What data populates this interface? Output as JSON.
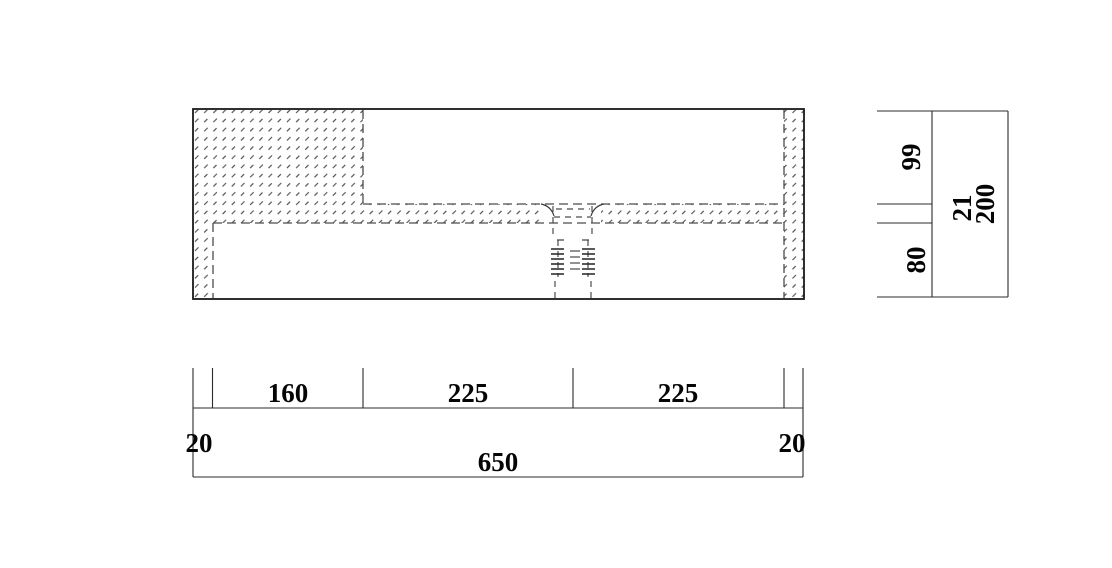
{
  "page": {
    "background": "#ffffff"
  },
  "colors": {
    "outline": "#1a1a1a",
    "hidden_line": "#4c4c4c",
    "hatch": "#3f3f3f",
    "dimension_line": "#2b2b2b",
    "text": "#050505"
  },
  "dimensions": {
    "height": {
      "upper": "99",
      "slab": "21",
      "total": "200",
      "lower": "80"
    },
    "width": {
      "left_edge": "20",
      "segment_1": "160",
      "segment_2": "225",
      "segment_3": "225",
      "right_edge": "20",
      "total": "650"
    }
  }
}
